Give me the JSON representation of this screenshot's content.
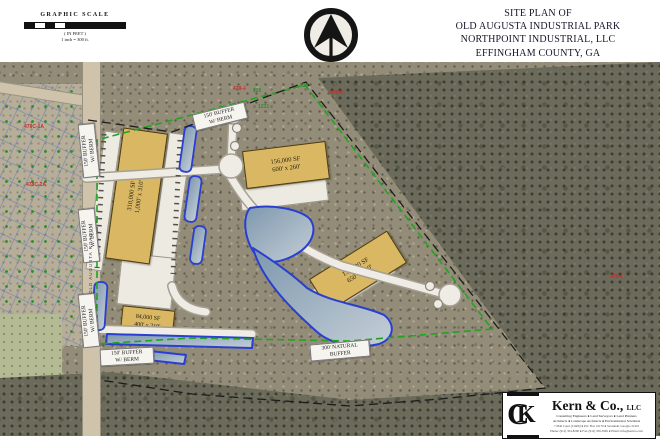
{
  "title_block": {
    "lines": [
      "SITE PLAN OF",
      "OLD AUGUSTA INDUSTRIAL PARK",
      "NORTHPOINT INDUSTRIAL, LLC",
      "EFFINGHAM COUNTY, GA"
    ],
    "date": "JUNE 24, 2024"
  },
  "scale_bar": {
    "title": "GRAPHIC SCALE",
    "in_feet": "( IN FEET )",
    "ratio": "1 inch = 300 ft."
  },
  "buildings": [
    {
      "sf": "310,000 SF",
      "dims": "1,000' x 310'"
    },
    {
      "sf": "156,000 SF",
      "dims": "600' x 260'"
    },
    {
      "sf": "136,500 SF",
      "dims": "650' x 210'"
    },
    {
      "sf": "84,000 SF",
      "dims": "400' x 210'"
    }
  ],
  "buffer_labels": [
    {
      "l1": "150' BUFFER",
      "l2": "W/ BERM"
    },
    {
      "l1": "150' BUFFER",
      "l2": "W/ BERM"
    },
    {
      "l1": "150' BUFFER",
      "l2": "W/ BERM"
    },
    {
      "l1": "150' BUFFER",
      "l2": "W/ BERM"
    },
    {
      "l1": "150' BUFFER",
      "l2": "W/ BERM"
    },
    {
      "l1": "300' NATURAL",
      "l2": "BUFFER"
    }
  ],
  "parcel_labels": {
    "red": [
      "478-4",
      "478-8",
      "478-4",
      "478C-1A",
      "478C-2A"
    ],
    "green": [
      "120",
      "528",
      "1231"
    ]
  },
  "road": {
    "name": "OLD AUGUSTA ROAD"
  },
  "logo": {
    "company": "Kern & Co.,",
    "suffix": "LLC",
    "services1": "Consulting Engineers ● Land Surveyors ● Land Planners",
    "services2": "Architects ● Landscape Architects ● Environmental Scientists",
    "address": "7 Mall Court (31406) ● P.O. Box 16179 ● Savannah, Georgia 31416",
    "contact": "Phone: (912) 354-8200 ● Fax: (912) 356-3965 ● Email: info@kernco.com"
  },
  "colors": {
    "building_fill": "#d9b763",
    "pond_stroke": "#2a3fd0",
    "buffer_green": "#1fa51f",
    "boundary_black": "#1c1c1c"
  }
}
